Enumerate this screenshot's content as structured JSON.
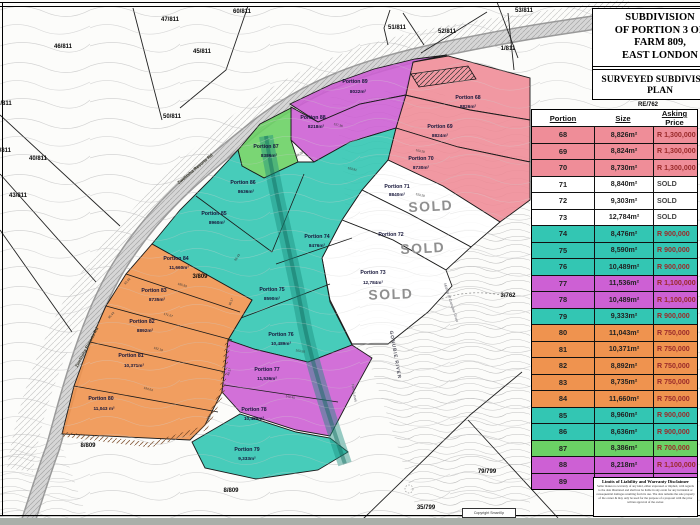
{
  "colors": {
    "pink": "#ef8d98",
    "teal": "#33c6b3",
    "magenta": "#cd60d4",
    "orange": "#ef934f",
    "green": "#6bd165",
    "white": "#ffffff",
    "price_text": "#9a2a2a",
    "sold_text": "#444444",
    "sold_map": "#8f8f8f"
  },
  "title_block": {
    "lines": [
      "SUBDIVISION",
      "OF PORTION 3 OF",
      "FARM 809,",
      "EAST LONDON"
    ],
    "subtitle_lines": [
      "SURVEYED SUBDIVISION",
      "PLAN"
    ]
  },
  "table": {
    "headers": [
      "Portion",
      "Size",
      "Asking Price"
    ],
    "rows": [
      {
        "portion": "68",
        "size": "8,826m²",
        "price": "R 1,300,000",
        "color": "pink"
      },
      {
        "portion": "69",
        "size": "8,824m²",
        "price": "R 1,300,000",
        "color": "pink"
      },
      {
        "portion": "70",
        "size": "8,730m²",
        "price": "R 1,300,000",
        "color": "pink"
      },
      {
        "portion": "71",
        "size": "8,840m²",
        "price": "SOLD",
        "color": "white"
      },
      {
        "portion": "72",
        "size": "9,303m²",
        "price": "SOLD",
        "color": "white"
      },
      {
        "portion": "73",
        "size": "12,784m²",
        "price": "SOLD",
        "color": "white"
      },
      {
        "portion": "74",
        "size": "8,476m²",
        "price": "R 900,000",
        "color": "teal"
      },
      {
        "portion": "75",
        "size": "8,590m²",
        "price": "R 900,000",
        "color": "teal"
      },
      {
        "portion": "76",
        "size": "10,489m²",
        "price": "R 900,000",
        "color": "teal"
      },
      {
        "portion": "77",
        "size": "11,536m²",
        "price": "R 1,100,000",
        "color": "magenta"
      },
      {
        "portion": "78",
        "size": "10,489m²",
        "price": "R 1,100,000",
        "color": "magenta"
      },
      {
        "portion": "79",
        "size": "9,333m²",
        "price": "R 900,000",
        "color": "teal"
      },
      {
        "portion": "80",
        "size": "11,043m²",
        "price": "R 750,000",
        "color": "orange"
      },
      {
        "portion": "81",
        "size": "10,371m²",
        "price": "R 750,000",
        "color": "orange"
      },
      {
        "portion": "82",
        "size": "8,892m²",
        "price": "R 750,000",
        "color": "orange"
      },
      {
        "portion": "83",
        "size": "8,735m²",
        "price": "R 750,000",
        "color": "orange"
      },
      {
        "portion": "84",
        "size": "11,660m²",
        "price": "R 750,000",
        "color": "orange"
      },
      {
        "portion": "85",
        "size": "8,960m²",
        "price": "R 900,000",
        "color": "teal"
      },
      {
        "portion": "86",
        "size": "8,636m²",
        "price": "R 900,000",
        "color": "teal"
      },
      {
        "portion": "87",
        "size": "8,386m²",
        "price": "R 700,000",
        "color": "green"
      },
      {
        "portion": "88",
        "size": "8,218m²",
        "price": "R 1,100,000",
        "color": "magenta"
      },
      {
        "portion": "89",
        "size": "8,022m²",
        "price": "R 1,100,000",
        "color": "magenta"
      }
    ]
  },
  "disclaimer": {
    "title": "Limits of Liability and Warranty Disclaimer",
    "body": "Seller makes no warranty of any kind, either expressed or implied, with regards to the data illustrated and shall not be liable in any event for any incidental or consequential damages resulting from its use. The data remains the sole property of the owner & may only be used for the purpose of a proposal with the prior written approval of the owner."
  },
  "map": {
    "copyright": "Copyright SmartXp",
    "labels": [
      {
        "t": "Portion 68",
        "x": 468,
        "y": 99,
        "c": "pn"
      },
      {
        "t": "8826m²",
        "x": 468,
        "y": 108,
        "c": "ps"
      },
      {
        "t": "Portion 69",
        "x": 440,
        "y": 128,
        "c": "pn"
      },
      {
        "t": "8824m²",
        "x": 440,
        "y": 137,
        "c": "ps"
      },
      {
        "t": "Portion 70",
        "x": 421,
        "y": 160,
        "c": "pn"
      },
      {
        "t": "8730m²",
        "x": 421,
        "y": 169,
        "c": "ps"
      },
      {
        "t": "Portion 71",
        "x": 397,
        "y": 188,
        "c": "pn"
      },
      {
        "t": "8840m²",
        "x": 397,
        "y": 196,
        "c": "ps"
      },
      {
        "t": "Portion 72",
        "x": 391,
        "y": 236,
        "c": "pn"
      },
      {
        "t": "Portion 73",
        "x": 373,
        "y": 274,
        "c": "pn"
      },
      {
        "t": "12,784m²",
        "x": 373,
        "y": 284,
        "c": "ps"
      },
      {
        "t": "Portion 74",
        "x": 317,
        "y": 238,
        "c": "pn"
      },
      {
        "t": "8476m²",
        "x": 317,
        "y": 247,
        "c": "ps"
      },
      {
        "t": "Portion 75",
        "x": 272,
        "y": 291,
        "c": "pn"
      },
      {
        "t": "8590m²",
        "x": 272,
        "y": 300,
        "c": "ps"
      },
      {
        "t": "Portion 76",
        "x": 281,
        "y": 336,
        "c": "pn"
      },
      {
        "t": "10,489m²",
        "x": 281,
        "y": 345,
        "c": "ps"
      },
      {
        "t": "Portion 77",
        "x": 267,
        "y": 371,
        "c": "pn"
      },
      {
        "t": "11,536m²",
        "x": 267,
        "y": 380,
        "c": "ps"
      },
      {
        "t": "Portion 78",
        "x": 254,
        "y": 411,
        "c": "pn"
      },
      {
        "t": "10,489m²",
        "x": 254,
        "y": 420,
        "c": "ps"
      },
      {
        "t": "Portion 79",
        "x": 247,
        "y": 451,
        "c": "pn"
      },
      {
        "t": "9,333m²",
        "x": 247,
        "y": 460,
        "c": "ps"
      },
      {
        "t": "Portion 80",
        "x": 101,
        "y": 400,
        "c": "pn"
      },
      {
        "t": "11,043 m²",
        "x": 104,
        "y": 410,
        "c": "ps"
      },
      {
        "t": "Portion 81",
        "x": 131,
        "y": 357,
        "c": "pn"
      },
      {
        "t": "10,371m²",
        "x": 134,
        "y": 367,
        "c": "ps"
      },
      {
        "t": "Portion 82",
        "x": 142,
        "y": 323,
        "c": "pn"
      },
      {
        "t": "8892m²",
        "x": 145,
        "y": 332,
        "c": "ps"
      },
      {
        "t": "Portion 83",
        "x": 154,
        "y": 292,
        "c": "pn"
      },
      {
        "t": "8735m²",
        "x": 157,
        "y": 301,
        "c": "ps"
      },
      {
        "t": "Portion 84",
        "x": 176,
        "y": 260,
        "c": "pn"
      },
      {
        "t": "11,660m²",
        "x": 179,
        "y": 269,
        "c": "ps"
      },
      {
        "t": "Portion 85",
        "x": 214,
        "y": 215,
        "c": "pn"
      },
      {
        "t": "8960m²",
        "x": 217,
        "y": 224,
        "c": "ps"
      },
      {
        "t": "Portion 86",
        "x": 243,
        "y": 184,
        "c": "pn"
      },
      {
        "t": "8636m²",
        "x": 246,
        "y": 193,
        "c": "ps"
      },
      {
        "t": "Portion 87",
        "x": 266,
        "y": 148,
        "c": "pn"
      },
      {
        "t": "8386m²",
        "x": 269,
        "y": 157,
        "c": "ps"
      },
      {
        "t": "Portion 88",
        "x": 313,
        "y": 119,
        "c": "pn"
      },
      {
        "t": "8218m²",
        "x": 316,
        "y": 128,
        "c": "ps"
      },
      {
        "t": "Portion 89",
        "x": 355,
        "y": 83,
        "c": "pn"
      },
      {
        "t": "8022m²",
        "x": 358,
        "y": 93,
        "c": "ps"
      },
      {
        "t": "SOLD",
        "x": 431,
        "y": 211,
        "c": "sold",
        "r": -3
      },
      {
        "t": "SOLD",
        "x": 423,
        "y": 253,
        "c": "sold",
        "r": -3
      },
      {
        "t": "SOLD",
        "x": 391,
        "y": 299,
        "c": "sold",
        "r": -2
      },
      {
        "t": "46/811",
        "x": 63,
        "y": 48,
        "c": "cad"
      },
      {
        "t": "47/811",
        "x": 170,
        "y": 21,
        "c": "cad"
      },
      {
        "t": "45/811",
        "x": 202,
        "y": 53,
        "c": "cad"
      },
      {
        "t": "60/811",
        "x": 242,
        "y": 13,
        "c": "cad"
      },
      {
        "t": "51/811",
        "x": 397,
        "y": 29,
        "c": "cad"
      },
      {
        "t": "52/811",
        "x": 447,
        "y": 33,
        "c": "cad"
      },
      {
        "t": "53/811",
        "x": 524,
        "y": 12,
        "c": "cad"
      },
      {
        "t": "1/811",
        "x": 508,
        "y": 50,
        "c": "cad"
      },
      {
        "t": "/811",
        "x": 6,
        "y": 105,
        "c": "cad"
      },
      {
        "t": "44/811",
        "x": 2,
        "y": 152,
        "c": "cad"
      },
      {
        "t": "40/811",
        "x": 38,
        "y": 160,
        "c": "cad"
      },
      {
        "t": "43/811",
        "x": 18,
        "y": 197,
        "c": "cad"
      },
      {
        "t": "50/811",
        "x": 172,
        "y": 118,
        "c": "cad"
      },
      {
        "t": "RE/762",
        "x": 648,
        "y": 106,
        "c": "cad",
        "fs": 5
      },
      {
        "t": "3/762",
        "x": 508,
        "y": 297,
        "c": "cad"
      },
      {
        "t": "3/809",
        "x": 200,
        "y": 278,
        "c": "cad"
      },
      {
        "t": "8/809",
        "x": 88,
        "y": 447,
        "c": "cad"
      },
      {
        "t": "8/809",
        "x": 231,
        "y": 492,
        "c": "cad"
      },
      {
        "t": "35/799",
        "x": 426,
        "y": 509,
        "c": "cad"
      },
      {
        "t": "79/799",
        "x": 487,
        "y": 473,
        "c": "cad"
      },
      {
        "t": "Zwelitsha Resorts Rd",
        "x": 196,
        "y": 170,
        "c": "road",
        "r": -40
      },
      {
        "t": "Zwelitsha Resorts Rd",
        "x": 88,
        "y": 348,
        "c": "road",
        "r": -62
      },
      {
        "t": "GONUBIE RIVER",
        "x": 394,
        "y": 355,
        "c": "river",
        "r": 80
      },
      {
        "t": "Middle of Gonubie River",
        "x": 450,
        "y": 303,
        "c": "riv2",
        "r": 72
      },
      {
        "t": "New Level",
        "x": 353,
        "y": 393,
        "c": "riv2",
        "r": 80
      },
      {
        "t": "157.36",
        "x": 338,
        "y": 126,
        "c": "dim",
        "r": 14
      },
      {
        "t": "103.81",
        "x": 352,
        "y": 170,
        "c": "dim",
        "r": 14
      },
      {
        "t": "103.28",
        "x": 420,
        "y": 152,
        "c": "dim",
        "r": 13
      },
      {
        "t": "153.28",
        "x": 420,
        "y": 196,
        "c": "dim",
        "r": 13
      },
      {
        "t": "93.30",
        "x": 300,
        "y": 155,
        "c": "dim",
        "r": -30
      },
      {
        "t": "185.83",
        "x": 182,
        "y": 286,
        "c": "dim",
        "r": 16
      },
      {
        "t": "171.67",
        "x": 168,
        "y": 316,
        "c": "dim",
        "r": 16
      },
      {
        "t": "192.19",
        "x": 158,
        "y": 350,
        "c": "dim",
        "r": 16
      },
      {
        "t": "194.64",
        "x": 148,
        "y": 390,
        "c": "dim",
        "r": 16
      },
      {
        "t": "98.43",
        "x": 238,
        "y": 258,
        "c": "dim",
        "r": -55
      },
      {
        "t": "96.17",
        "x": 232,
        "y": 302,
        "c": "dim",
        "r": -70
      },
      {
        "t": "93.92",
        "x": 128,
        "y": 282,
        "c": "dim",
        "r": -48
      },
      {
        "t": "95.43",
        "x": 112,
        "y": 316,
        "c": "dim",
        "r": -48
      },
      {
        "t": "48.17",
        "x": 230,
        "y": 372,
        "c": "dim",
        "r": -75
      },
      {
        "t": "68.17",
        "x": 210,
        "y": 418,
        "c": "dim",
        "r": -70
      },
      {
        "t": "140.45",
        "x": 290,
        "y": 398,
        "c": "dim",
        "r": 12
      },
      {
        "t": "163.50",
        "x": 300,
        "y": 352,
        "c": "dim",
        "r": 10
      }
    ]
  }
}
